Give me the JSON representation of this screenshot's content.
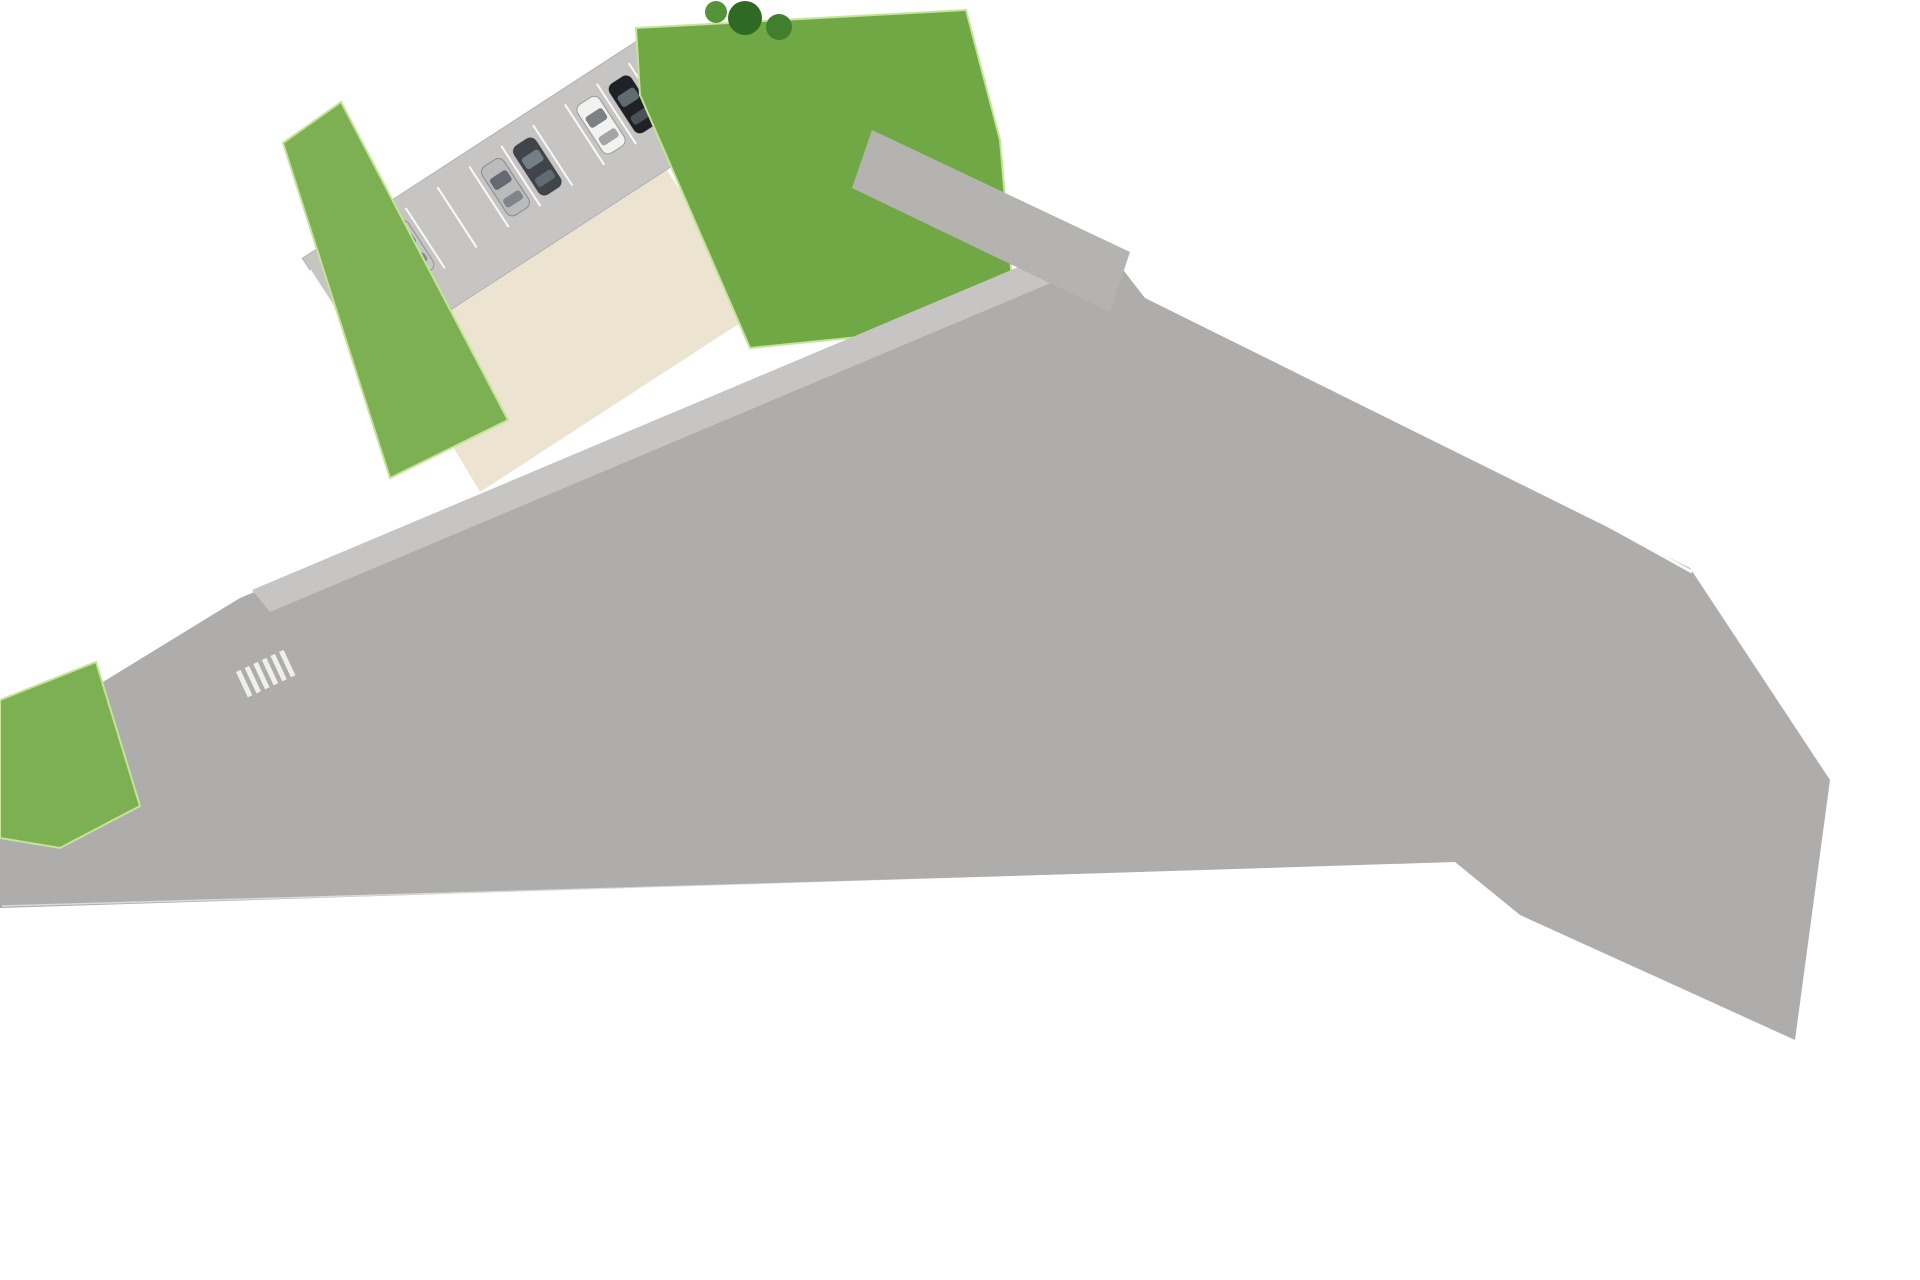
{
  "meta": {
    "kind": "residential-development-site-plan"
  },
  "palette": {
    "bg": "#ffffff",
    "road": "#aeadab",
    "road_light": "#c6c5c3",
    "road_top": "#b5b3b0",
    "wedge_a": "#96948e",
    "wedge_b": "#7d7b76",
    "road_br": "#b7b5b0",
    "lawn": "#7db052",
    "lawn2": "#6fa845",
    "lawn_dark": "#4a7c2d",
    "hedge": "#3c6b26",
    "cream": "#efe8d9",
    "cream2": "#ece4d1",
    "house_base": "#f8f5ee",
    "terrace": "#ece3cf",
    "roof": "#fcfbf8",
    "wall": "#2c2924",
    "garden": "#78ab49",
    "patio": "#cdbd9e",
    "pool": "#31a0d8",
    "pool_ripple": "#74c4ea",
    "padel": "#58aee0",
    "sand": "#cbb98c",
    "pink": "#e81e8c",
    "deck": "#b6b4af",
    "yellow_car": "#e4cd3e",
    "guard_gold": "#e9c43b",
    "label_color": "#fdfdfb"
  },
  "padel_court": {
    "label": "PISTA DE PADEL"
  },
  "entrance": {
    "arrow_icon": "entrance-arrow-icon",
    "arrow_color": "#e81e8c"
  },
  "security": {
    "icon": "security-guard-icon"
  },
  "parking": {
    "car_colors": [
      "#23262b",
      "#c6c7c9",
      "#babbbd",
      "#41454b",
      "#f2f2f0",
      "#1e2126"
    ]
  },
  "icons": [
    "palm-tree-icon",
    "parasol-icon",
    "sun-lounger-icon",
    "car-icon",
    "round-table-icon",
    "security-guard-icon",
    "entrance-arrow-icon"
  ],
  "blocks": [
    {
      "id": "11",
      "angle": -26,
      "rev": true,
      "units": [
        {
          "label": "11A",
          "x": 726,
          "y": 405
        },
        {
          "label": "11B",
          "x": 682,
          "y": 429
        },
        {
          "label": "11C",
          "x": 623,
          "y": 457
        },
        {
          "label": "11D",
          "x": 553,
          "y": 491
        }
      ]
    },
    {
      "id": "7",
      "angle": -25.5,
      "units": [
        {
          "label": "7A",
          "x": 1032,
          "y": 339
        },
        {
          "label": "7B",
          "x": 975,
          "y": 367
        },
        {
          "label": "7C",
          "x": 922,
          "y": 393
        },
        {
          "label": "7D",
          "x": 867,
          "y": 418
        }
      ]
    },
    {
      "id": "8",
      "angle": -25.5,
      "units": [
        {
          "label": "8A",
          "x": 770,
          "y": 466
        },
        {
          "label": "8B",
          "x": 709,
          "y": 497
        },
        {
          "label": "8C",
          "x": 659,
          "y": 521
        },
        {
          "label": "8D",
          "x": 603,
          "y": 545
        }
      ]
    },
    {
      "id": "9",
      "angle": -24,
      "units": [
        {
          "label": "9A",
          "x": 495,
          "y": 601
        },
        {
          "label": "9B",
          "x": 377,
          "y": 652
        }
      ]
    },
    {
      "id": "6",
      "angle": 2,
      "yard": 45,
      "units": [
        {
          "label": "6D",
          "x": 47,
          "y": 872
        },
        {
          "label": "6C",
          "x": 107,
          "y": 876
        },
        {
          "label": "6B",
          "x": 170,
          "y": 878
        },
        {
          "label": "6A",
          "x": 230,
          "y": 881
        }
      ]
    },
    {
      "id": "5",
      "angle": 1,
      "yard": 55,
      "units": [
        {
          "label": "5D",
          "x": 335,
          "y": 883
        },
        {
          "label": "5C",
          "x": 397,
          "y": 884
        },
        {
          "label": "5B",
          "x": 453,
          "y": 885
        },
        {
          "label": "5A",
          "x": 515,
          "y": 886
        }
      ]
    },
    {
      "id": "4",
      "angle": 1,
      "yard": 62,
      "units": [
        {
          "label": "4D",
          "x": 627,
          "y": 887
        },
        {
          "label": "4C",
          "x": 685,
          "y": 888
        },
        {
          "label": "4B",
          "x": 748,
          "y": 889
        },
        {
          "label": "4A",
          "x": 808,
          "y": 890
        }
      ]
    },
    {
      "id": "3",
      "angle": 1,
      "yard": 72,
      "units": [
        {
          "label": "3D",
          "x": 925,
          "y": 884
        },
        {
          "label": "3C",
          "x": 987,
          "y": 885
        },
        {
          "label": "3B",
          "x": 1048,
          "y": 886
        },
        {
          "label": "3A",
          "x": 1112,
          "y": 887
        }
      ]
    },
    {
      "id": "2",
      "angle": 2,
      "yard": 88,
      "units": [
        {
          "label": "2D",
          "x": 1230,
          "y": 899
        },
        {
          "label": "2C",
          "x": 1293,
          "y": 901
        },
        {
          "label": "2B",
          "x": 1352,
          "y": 902
        },
        {
          "label": "2A",
          "x": 1413,
          "y": 904
        }
      ]
    },
    {
      "id": "1",
      "angle": 8,
      "yard": 105,
      "units": [
        {
          "label": "1D",
          "x": 1540,
          "y": 922
        },
        {
          "label": "1C",
          "x": 1598,
          "y": 931
        },
        {
          "label": "1A",
          "x": 1688,
          "y": 942,
          "w": 88,
          "angle": 14
        }
      ]
    }
  ]
}
